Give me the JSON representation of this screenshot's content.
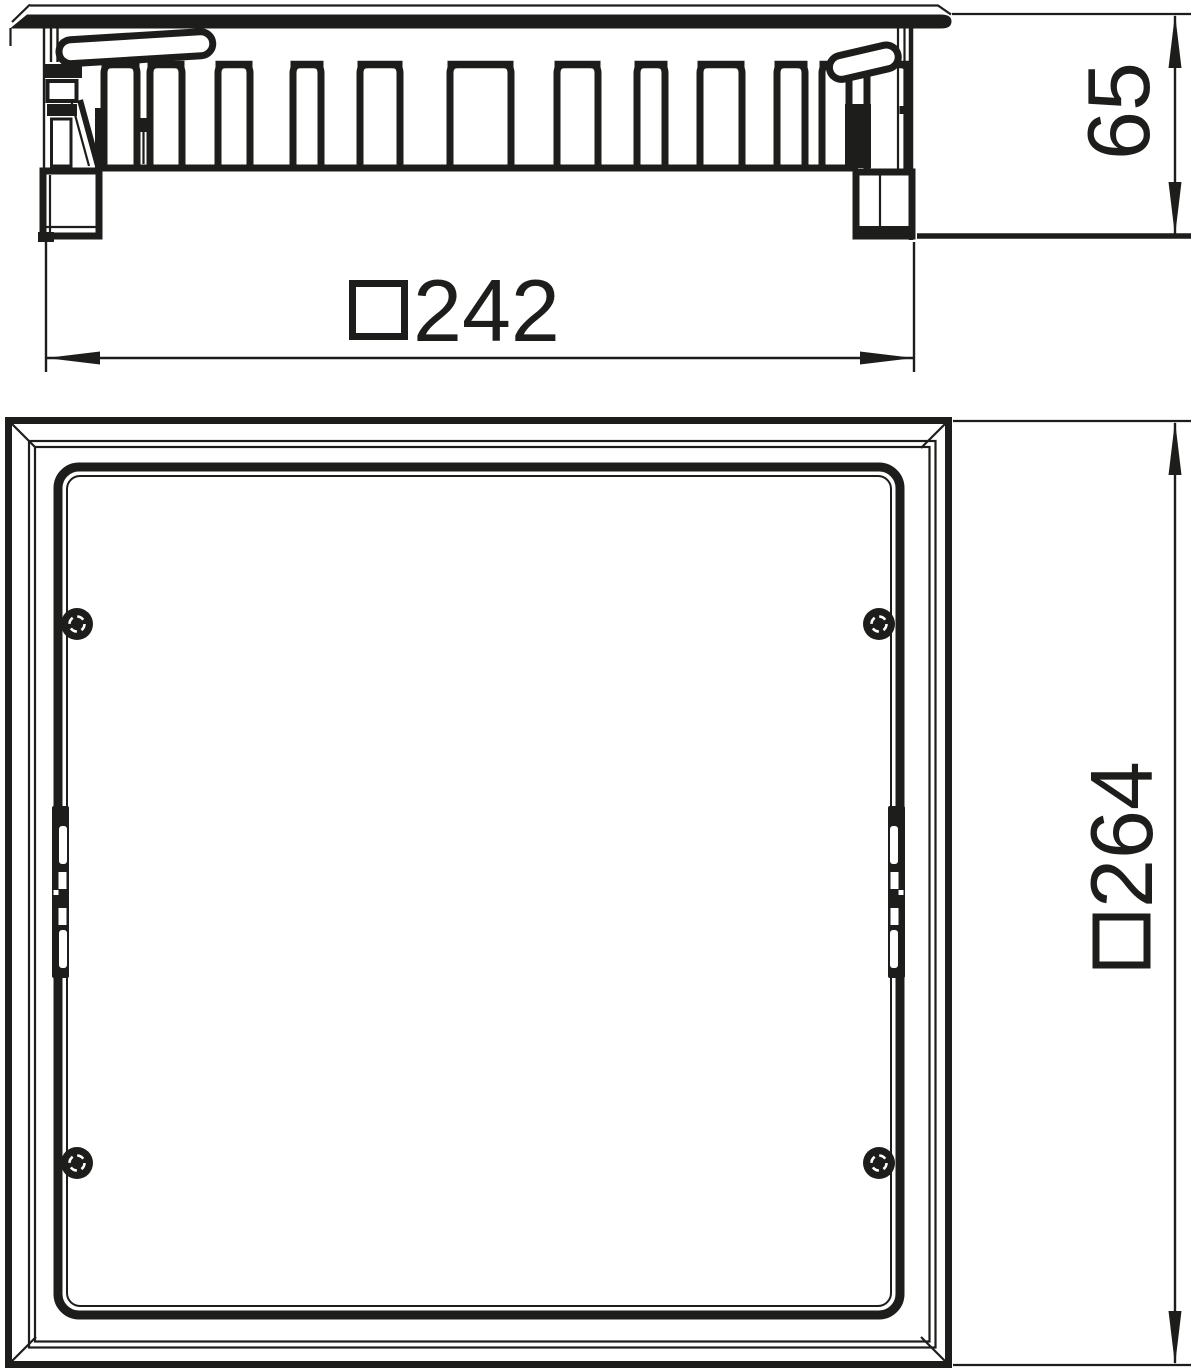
{
  "drawing": {
    "background": "#ffffff",
    "line_color": "#1d1d1b",
    "views": {
      "side_section": {
        "dim_width": {
          "symbol": "□",
          "value": "242",
          "display": "□242",
          "orientation": "horizontal"
        },
        "dim_height": {
          "value": "65",
          "display": "65",
          "orientation": "vertical"
        }
      },
      "plan": {
        "dim_outer": {
          "symbol": "□",
          "value": "264",
          "display": "□264",
          "orientation": "vertical"
        }
      }
    },
    "annotations": [
      "□242",
      "65",
      "□264"
    ]
  }
}
